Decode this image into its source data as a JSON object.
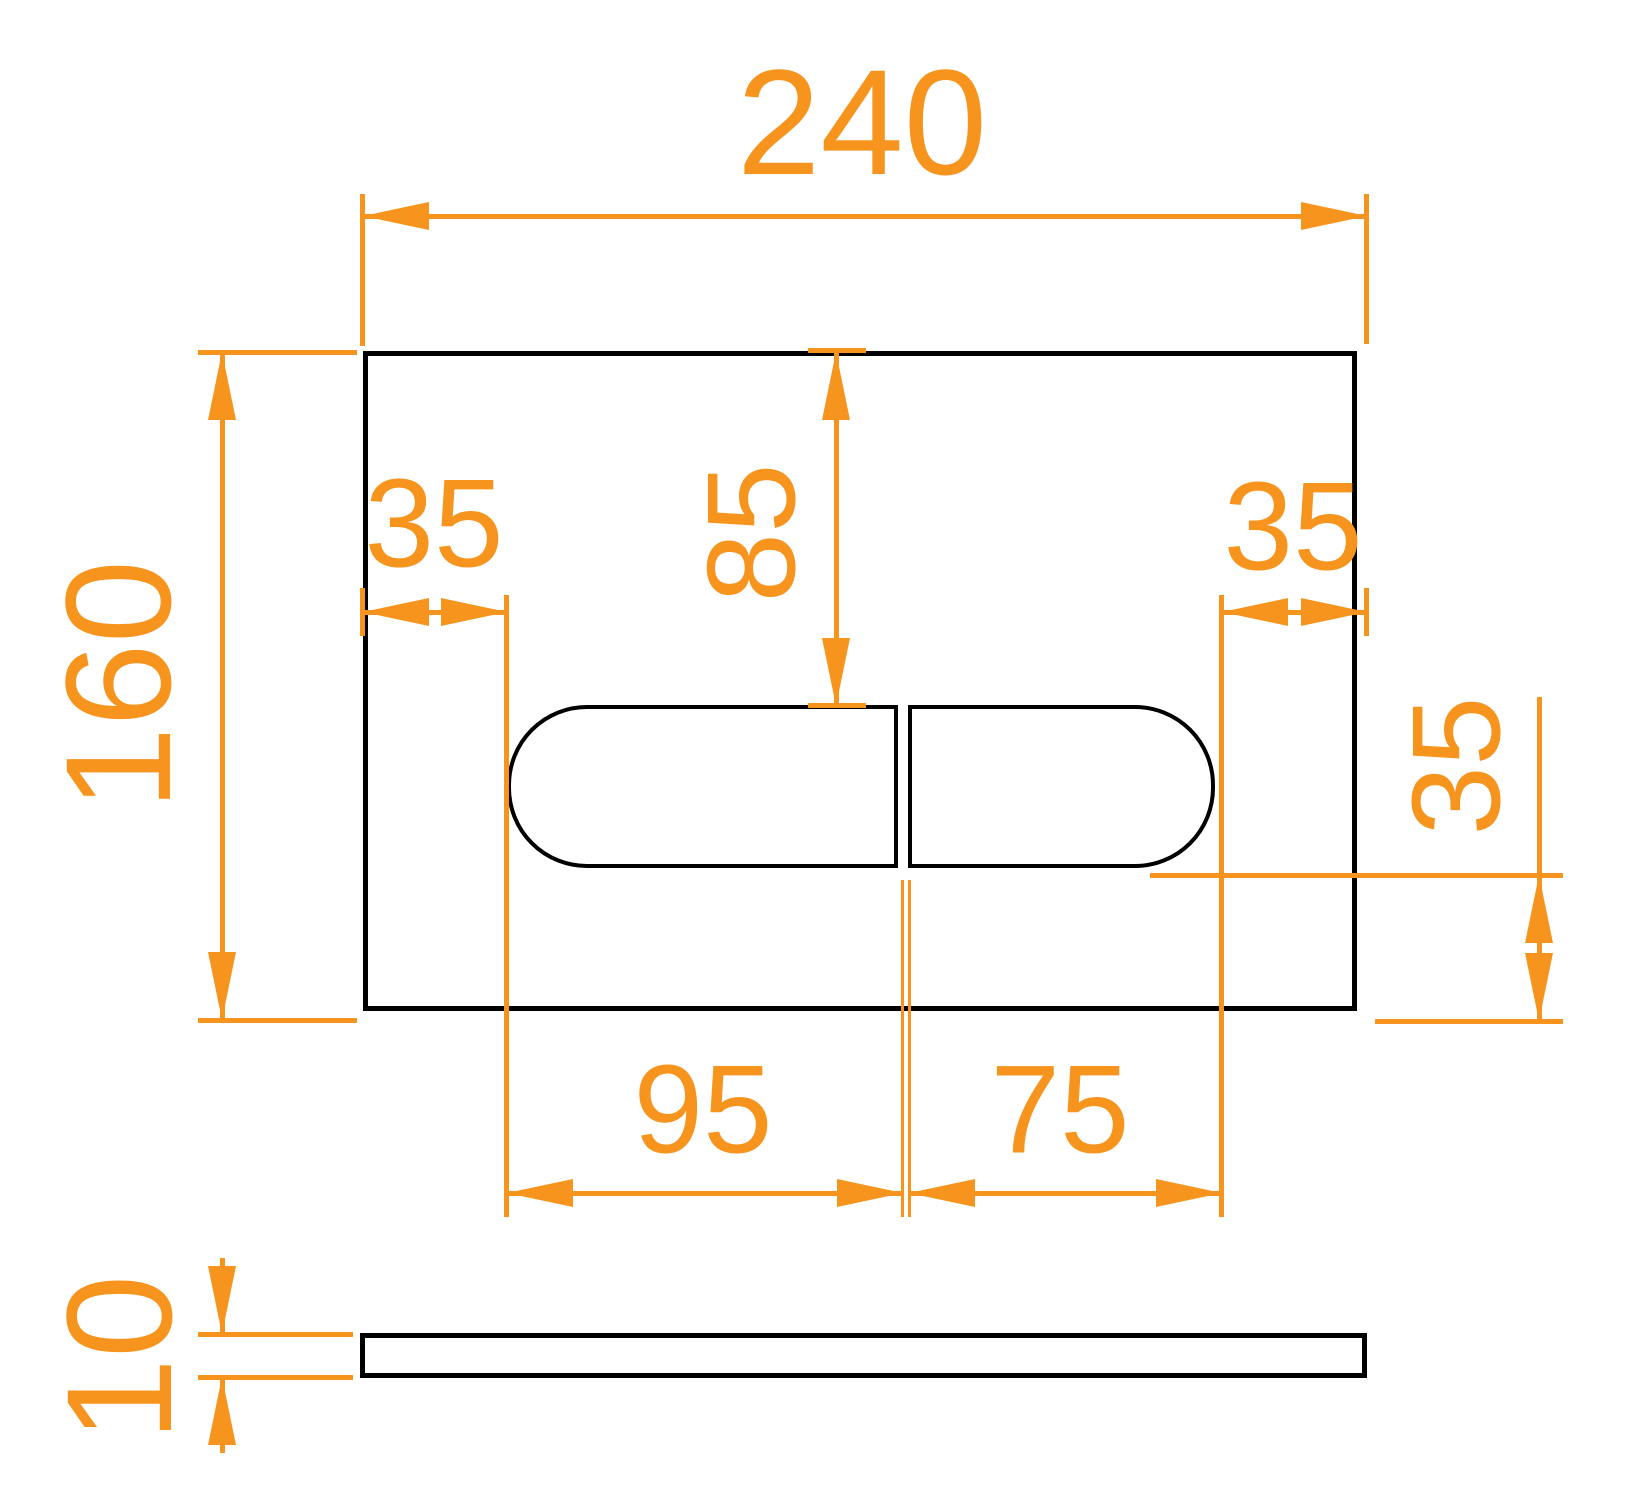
{
  "drawing": {
    "type": "technical-dimension-drawing",
    "subject": "dual-flush actuator plate, front view and side view",
    "units_implied": "mm",
    "colors": {
      "dimension": "#F7941E",
      "outline": "#000000",
      "background": "#FFFFFF"
    },
    "front_view": {
      "plate_width_label": "240",
      "plate_height_label": "160",
      "left_button_margin_label": "35",
      "right_button_margin_label": "35",
      "top_to_button_label": "85",
      "button_to_bottom_label": "35",
      "left_button_width_label": "95",
      "right_button_width_label": "75"
    },
    "side_view": {
      "thickness_label": "10"
    }
  }
}
